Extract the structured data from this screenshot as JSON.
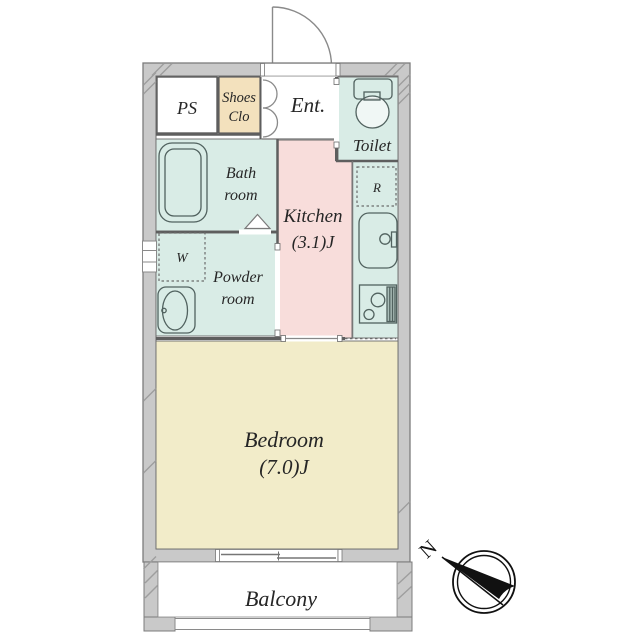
{
  "floor_plan": {
    "rooms": {
      "ps": {
        "label": "PS",
        "color": "#ffffff"
      },
      "shoes_closet": {
        "label_lines": [
          "Shoes",
          "Clo"
        ],
        "color": "#f3e1bd"
      },
      "entrance": {
        "label": "Ent.",
        "color": "#ffffff"
      },
      "toilet": {
        "label": "Toilet",
        "color": "#d9ece6"
      },
      "bathroom": {
        "label_lines": [
          "Bath",
          "room"
        ],
        "color": "#d9ece6"
      },
      "kitchen": {
        "label_lines": [
          "Kitchen",
          "(3.1)J"
        ],
        "color": "#f8dddb"
      },
      "kitchen_counter": {
        "color": "#d9ece6"
      },
      "powder_room": {
        "label_lines": [
          "Powder",
          "room"
        ],
        "color": "#d9ece6"
      },
      "washer_space": {
        "label": "W"
      },
      "refrigerator_space": {
        "label": "R"
      },
      "bedroom": {
        "label_lines": [
          "Bedroom",
          "(7.0)J"
        ],
        "color": "#f2ecc9"
      },
      "balcony": {
        "label": "Balcony",
        "color": "#ffffff"
      }
    },
    "compass": {
      "north": "N"
    },
    "colors": {
      "wall_fill": "#c9c9c9",
      "wall_stroke": "#7c7c7c",
      "interior_line": "#5e5e5e",
      "fixture_stroke": "#51625f",
      "hatch": "#9e9e9e",
      "text": "#262626"
    }
  }
}
